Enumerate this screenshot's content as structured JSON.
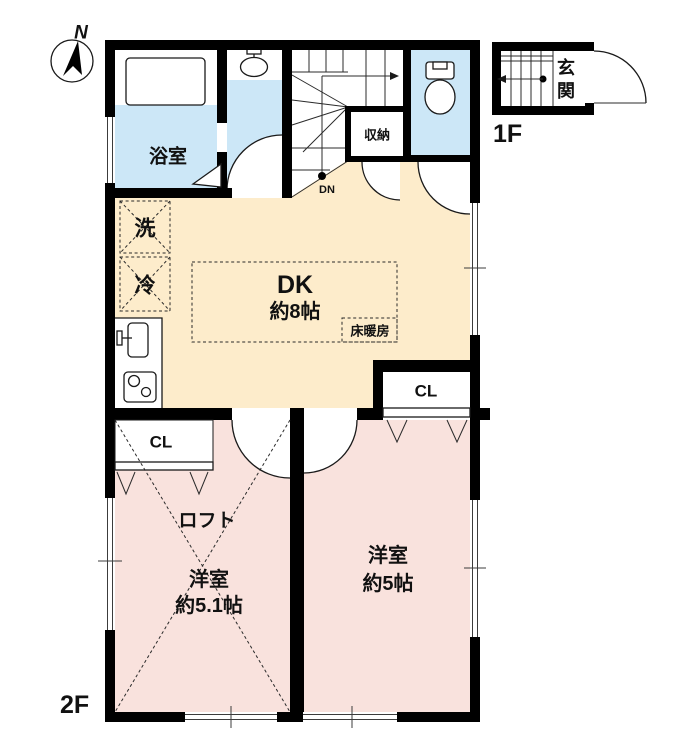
{
  "compass": {
    "north_label": "N"
  },
  "plan1f": {
    "floor_label": "1F",
    "entrance_char_top": "玄",
    "entrance_char_bottom": "関"
  },
  "plan2f": {
    "floor_label": "2F",
    "bathroom_label": "浴室",
    "storage_label": "収納",
    "stairs_down_label": "DN",
    "washer_label": "洗",
    "fridge_label": "冷",
    "dk_label": "DK",
    "dk_size": "約8帖",
    "floor_heating_label": "床暖房",
    "closet_dk_label": "CL",
    "closet_bedroom_label": "CL",
    "loft_label": "ロフト",
    "bedroom_left_label": "洋室",
    "bedroom_left_size": "約5.1帖",
    "bedroom_right_label": "洋室",
    "bedroom_right_size": "約5帖"
  },
  "colors": {
    "wall": "#000000",
    "dk_fill": "#fdeccb",
    "bedroom_fill": "#f9e2dd",
    "wet_area_fill": "#cce7f7",
    "line": "#1a1a1a"
  }
}
